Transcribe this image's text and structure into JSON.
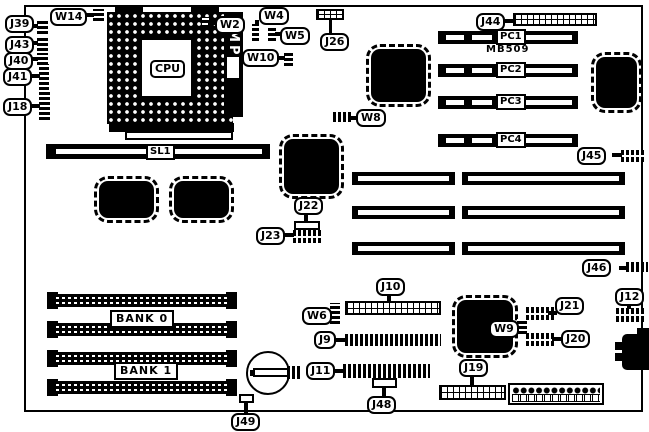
{
  "colors": {
    "ink": "#000000",
    "paper": "#ffffff"
  },
  "labels": {
    "w14": "W14",
    "j39": "J39",
    "j43": "J43",
    "j40": "J40",
    "j41": "J41",
    "j18": "J18",
    "cpu": "CPU",
    "amp": "AMP",
    "w2": "W2",
    "w10": "W10",
    "w4": "W4",
    "w5": "W5",
    "j26": "J26",
    "w8": "W8",
    "j44": "J44",
    "pc1": "PC1",
    "pc2": "PC2",
    "pc3": "PC3",
    "pc4": "PC4",
    "model": "MB509",
    "j45": "J45",
    "sl1": "SL1",
    "j22": "J22",
    "j23": "J23",
    "j46": "J46",
    "j12": "J12",
    "j10": "J10",
    "w6": "W6",
    "j9": "J9",
    "j11": "J11",
    "j48": "J48",
    "j49": "J49",
    "bank0": "BANK 0",
    "bank1": "BANK 1",
    "j19": "J19",
    "w9": "W9",
    "j21": "J21",
    "j20": "J20"
  }
}
